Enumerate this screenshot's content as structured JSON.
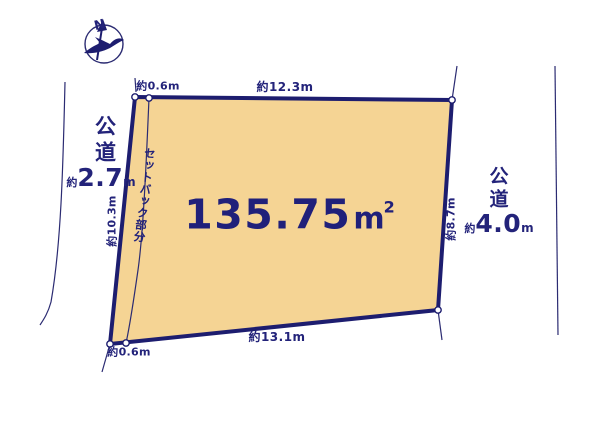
{
  "diagram": {
    "type": "land-plot-diagram",
    "compass": {
      "label": "N"
    },
    "plot": {
      "area_value": "135.75",
      "area_unit": "m",
      "area_exponent": "2"
    },
    "dimensions": {
      "top_setback": "約0.6m",
      "top_width": "約12.3m",
      "left_depth": "約10.3m",
      "right_depth": "約8.7m",
      "bottom_width": "約13.1m",
      "bottom_setback": "約0.6m"
    },
    "setback_label": "セットバック部分",
    "roads": {
      "left": {
        "name": "公道",
        "width_prefix": "約",
        "width_value": "2.7",
        "width_unit": "m"
      },
      "right": {
        "name": "公道",
        "width_prefix": "約",
        "width_value": "4.0",
        "width_unit": "m"
      }
    },
    "colors": {
      "plot_fill": "#F5D494",
      "boundary_navy": "#1D1D6F",
      "thin_line_navy": "#2B2B72",
      "text_navy": "#23237A",
      "background": "#FFFFFF"
    }
  }
}
